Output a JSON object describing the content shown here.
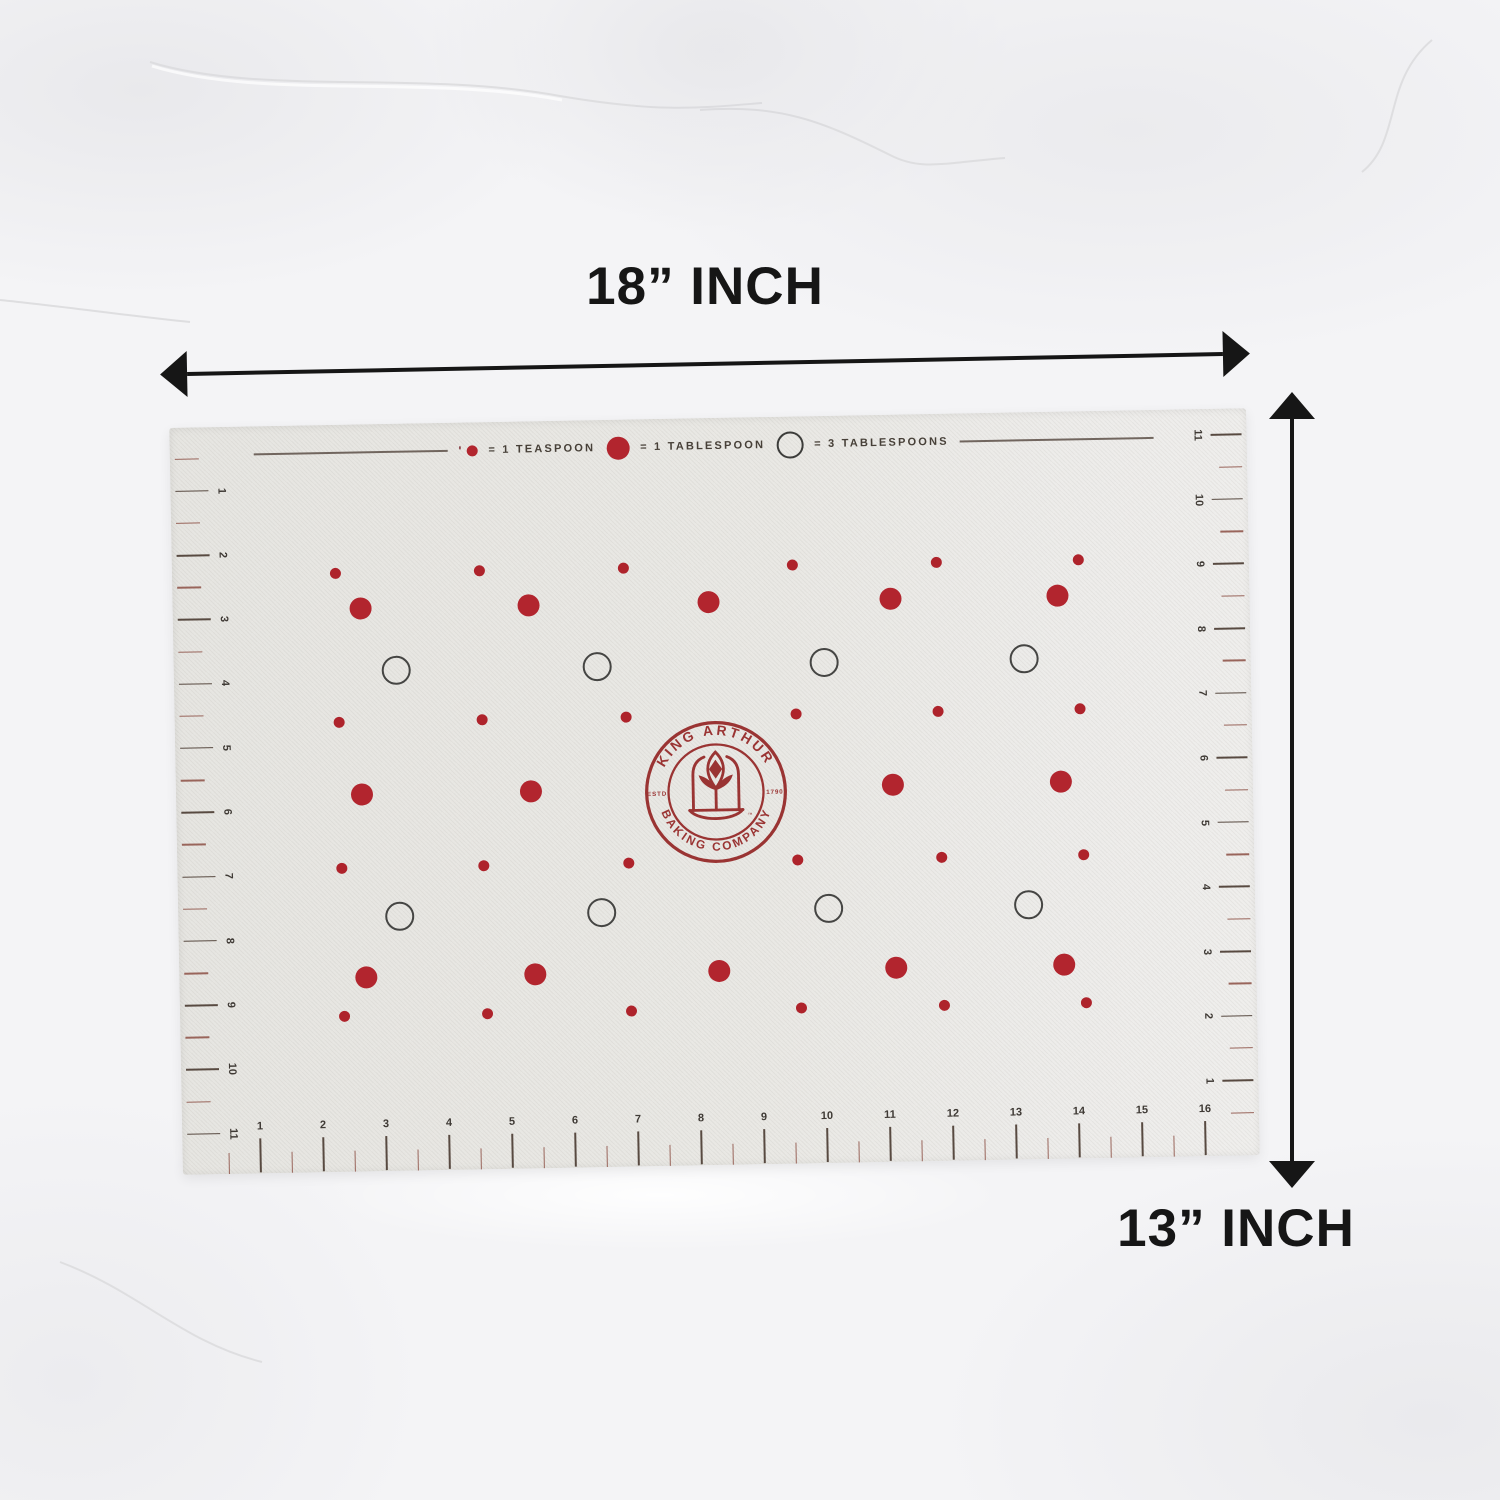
{
  "dimensions": {
    "width_label": "18” INCH",
    "height_label": "13” INCH"
  },
  "legend": {
    "tick_mark": "'",
    "items": [
      {
        "symbol": "small-dot",
        "label": "= 1 TEASPOON"
      },
      {
        "symbol": "medium-dot",
        "label": "= 1 TABLESPOON"
      },
      {
        "symbol": "outline-circle",
        "label": "= 3 TABLESPOONS"
      }
    ]
  },
  "logo": {
    "top_text": "KING ARTHUR",
    "bottom_text": "BAKING COMPANY",
    "estd": "ESTD",
    "year": "1790",
    "trademark": "™"
  },
  "rulers": {
    "left_numbers": [
      1,
      2,
      3,
      4,
      5,
      6,
      7,
      8,
      9,
      10,
      11
    ],
    "right_numbers": [
      11,
      10,
      9,
      8,
      7,
      6,
      5,
      4,
      3,
      2,
      1
    ],
    "bottom_numbers": [
      1,
      2,
      3,
      4,
      5,
      6,
      7,
      8,
      9,
      10,
      11,
      12,
      13,
      14,
      15,
      16
    ]
  },
  "dots": {
    "rows": [
      {
        "type": "small",
        "y": 148,
        "x": [
          163,
          307,
          451,
          620,
          764,
          906
        ]
      },
      {
        "type": "medium",
        "y": 184,
        "x": [
          188,
          356,
          536,
          718,
          885
        ]
      },
      {
        "type": "circle",
        "y": 246,
        "x": [
          222,
          423,
          650,
          850
        ]
      },
      {
        "type": "small",
        "y": 297,
        "x": [
          164,
          307,
          451,
          621,
          763,
          905
        ]
      },
      {
        "type": "medium",
        "y": 370,
        "x": [
          186,
          355,
          717,
          885
        ]
      },
      {
        "type": "small",
        "y": 443,
        "x": [
          164,
          306,
          451,
          620,
          764,
          906
        ]
      },
      {
        "type": "circle",
        "y": 492,
        "x": [
          221,
          423,
          650,
          850
        ]
      },
      {
        "type": "medium",
        "y": 553,
        "x": [
          187,
          356,
          540,
          717,
          885
        ]
      },
      {
        "type": "small",
        "y": 591,
        "x": [
          164,
          307,
          451,
          621,
          764,
          906
        ]
      }
    ]
  },
  "colors": {
    "dot_red": "#b2252e",
    "logo_red": "#9a3433",
    "tick_major": "#584a41",
    "tick_minor": "#99655b",
    "ruler_number": "#3f3a35",
    "arrow_black": "#161616",
    "legend_text": "#474038",
    "circle_outline": "#454543",
    "mat_base": "#e8e7e3"
  }
}
